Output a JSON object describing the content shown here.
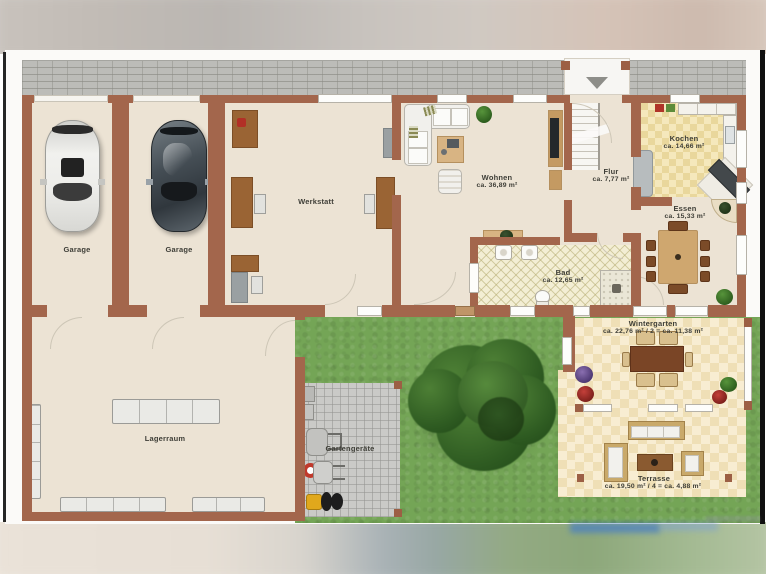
{
  "plan": {
    "rooms": {
      "garage1": {
        "label": "Garage"
      },
      "garage2": {
        "label": "Garage"
      },
      "werkstatt": {
        "label": "Werkstatt"
      },
      "wohnen": {
        "label": "Wohnen",
        "area": "ca. 36,89 m²"
      },
      "flur": {
        "label": "Flur",
        "area": "ca. 7,77 m²"
      },
      "kochen": {
        "label": "Kochen",
        "area": "ca. 14,66 m²"
      },
      "essen": {
        "label": "Essen",
        "area": "ca. 15,33 m²"
      },
      "bad": {
        "label": "Bad",
        "area": "ca. 12,65 m²"
      },
      "lagerraum": {
        "label": "Lagerraum"
      },
      "gartengeraete": {
        "label": "Gartengeräte"
      },
      "wintergarten": {
        "label": "Wintergarten",
        "area": "ca. 22,76 m² / 2 = ca. 11,38 m²"
      },
      "terrasse": {
        "label": "Terrasse",
        "area": "ca. 19,50 m² / 4 = ca. 4,88 m²"
      }
    },
    "colors": {
      "wall": "#a3664c",
      "floor_cream": "#ece3d4",
      "lawn_green": "#74a556",
      "kitchen_tile": "#f2e3b0",
      "conservatory_tile": "#f6ead0",
      "bath_tile": "#f3eed4",
      "driveway_gray": "#bcbcb8",
      "paving_gray": "#cacac7",
      "logo_blue": "#4a7fc1"
    }
  }
}
